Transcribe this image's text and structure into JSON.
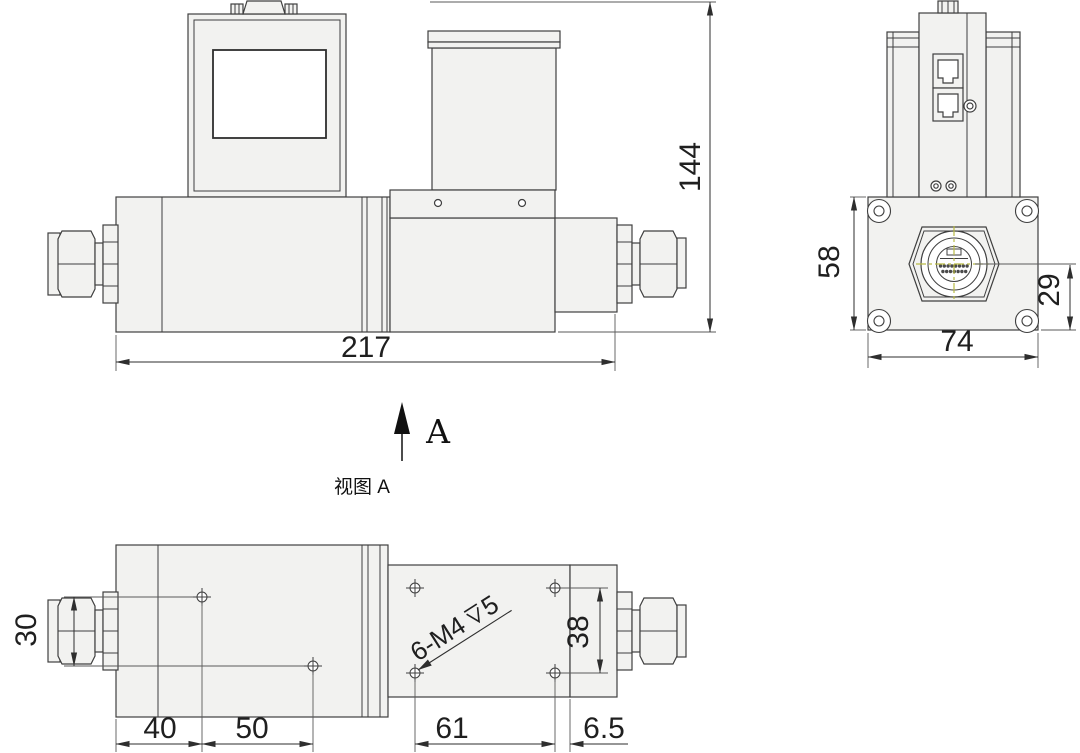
{
  "drawing_type": "technical-three-view",
  "colors": {
    "line": "#3f3f3f",
    "part_fill": "#f2f2f0",
    "screen_fill": "#ffffff",
    "centerline": "#b9ba45",
    "dimension_text": "#1f1f1f"
  },
  "front_view": {
    "length": "217",
    "height": "144"
  },
  "side_view": {
    "width": "74",
    "flange_height": "58",
    "connector_offset": "29"
  },
  "bottom_view": {
    "view_label": "视图 A",
    "arrow_label": "A",
    "hole_row_spacing": "30",
    "hole_offset_1": "40",
    "hole_offset_2": "50",
    "valve_hole_span": "61",
    "edge_offset": "6.5",
    "valve_hole_height": "38",
    "thread_callout": {
      "count_size": "6-M4",
      "depth": "5",
      "full": "6-M4↧5"
    }
  }
}
